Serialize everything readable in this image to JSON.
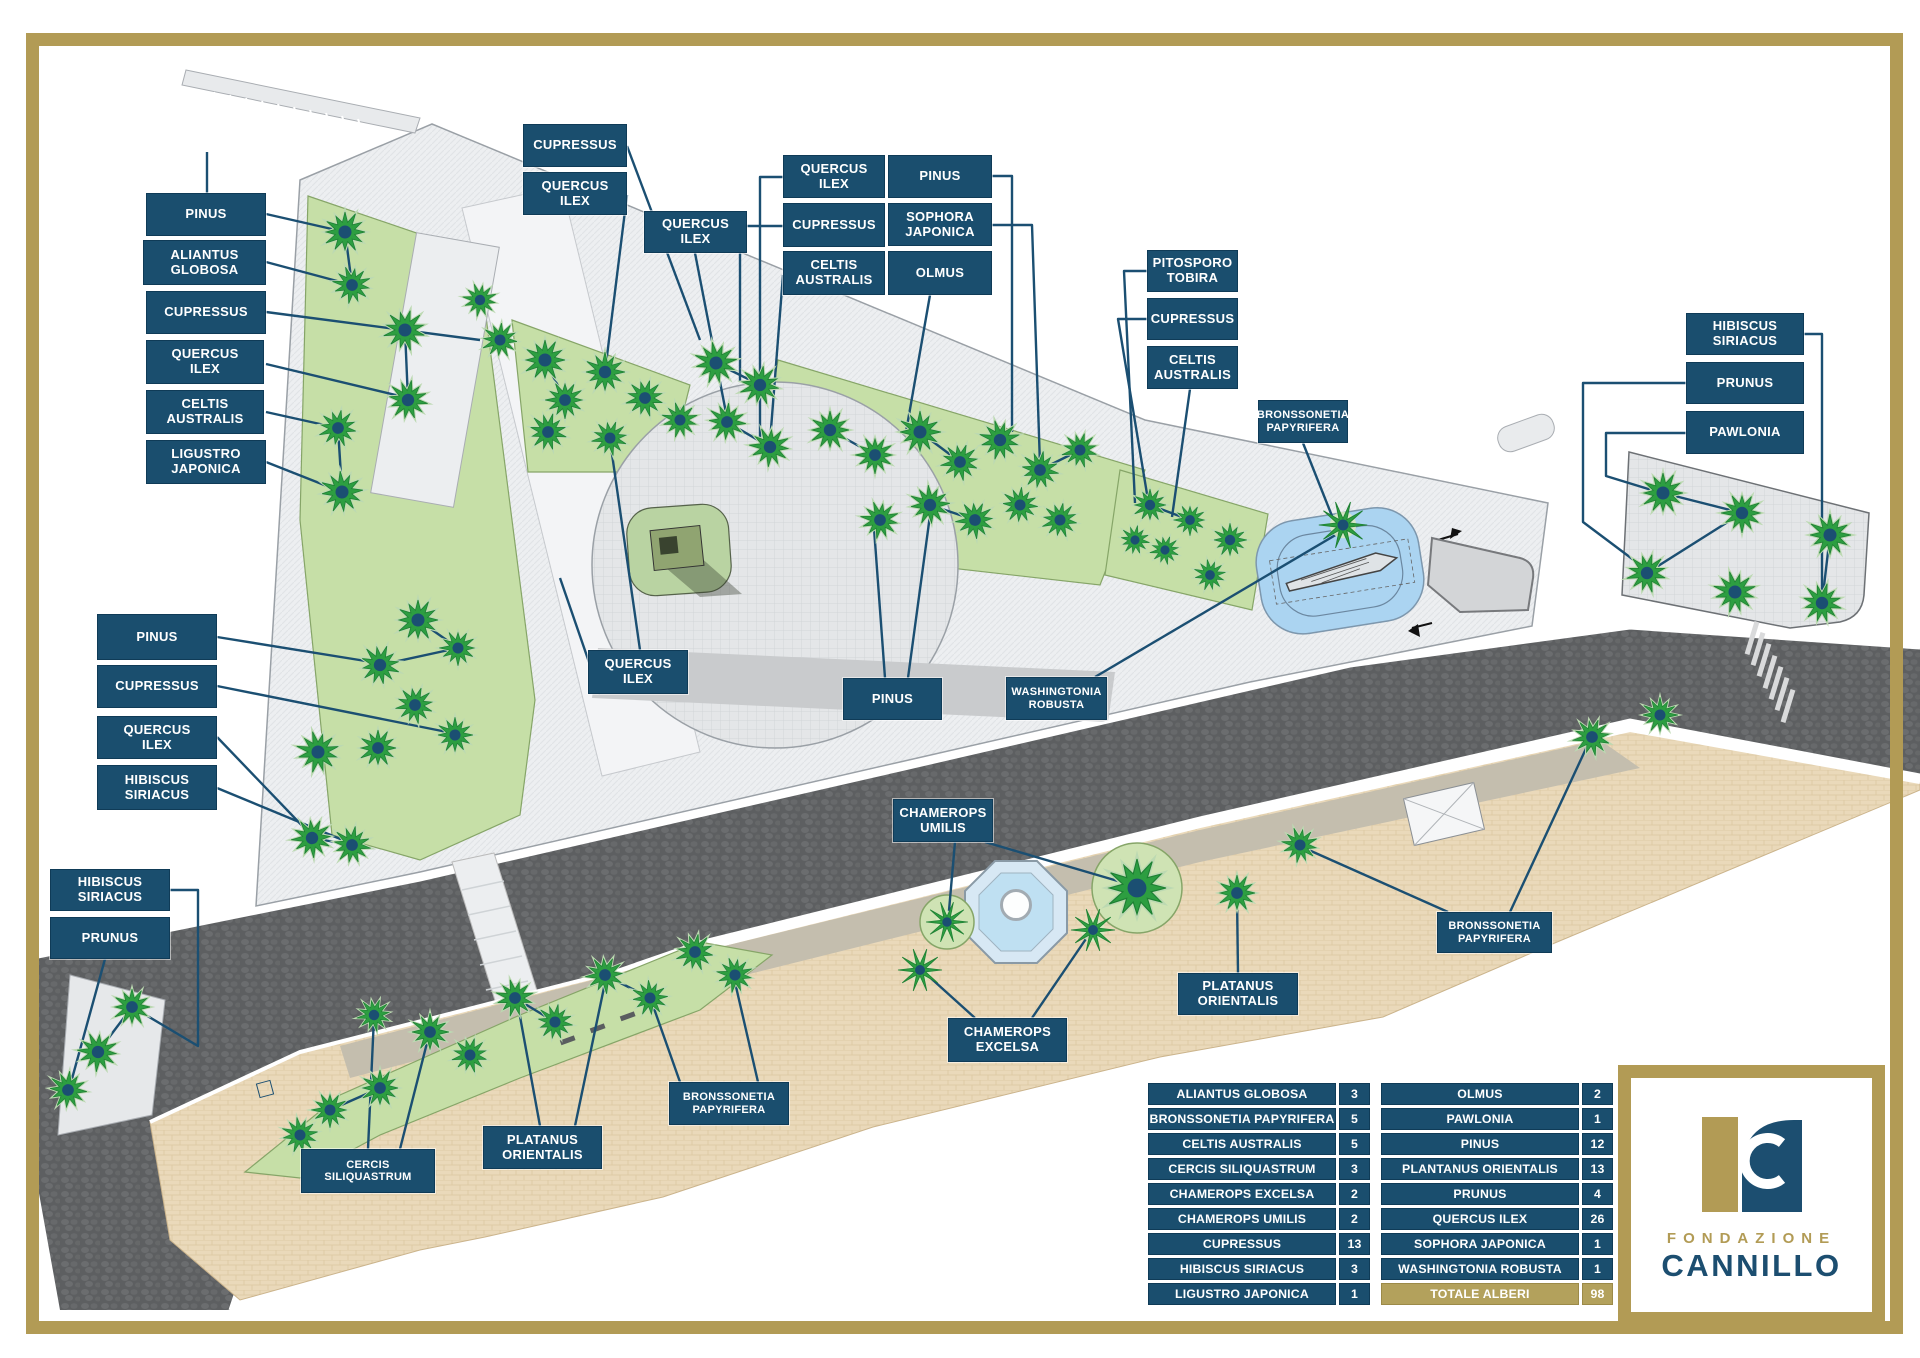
{
  "colors": {
    "frame_gold": "#b29b55",
    "label_navy": "#1a4e6e",
    "leader_navy": "#1b4f72",
    "lawn_green": "#c6dfa7",
    "tree_green": "#2d9e41",
    "road_dark": "#5d5f61",
    "promenade_beige": "#ead9ba",
    "water_blue": "#abd4f1",
    "legend_total_gold": "#b3a15c"
  },
  "map_labels": [
    {
      "text": "PINUS",
      "x": 146,
      "y": 193,
      "w": 120,
      "h": 43
    },
    {
      "text": "ALIANTUS\nGLOBOSA",
      "x": 143,
      "y": 240,
      "w": 123,
      "h": 45
    },
    {
      "text": "CUPRESSUS",
      "x": 146,
      "y": 291,
      "w": 120,
      "h": 43
    },
    {
      "text": "QUERCUS\nILEX",
      "x": 146,
      "y": 340,
      "w": 118,
      "h": 44
    },
    {
      "text": "CELTIS\nAUSTRALIS",
      "x": 146,
      "y": 390,
      "w": 118,
      "h": 44
    },
    {
      "text": "LIGUSTRO\nJAPONICA",
      "x": 146,
      "y": 440,
      "w": 120,
      "h": 44
    },
    {
      "text": "CUPRESSUS",
      "x": 523,
      "y": 124,
      "w": 104,
      "h": 43
    },
    {
      "text": "QUERCUS\nILEX",
      "x": 523,
      "y": 172,
      "w": 104,
      "h": 43
    },
    {
      "text": "QUERCUS\nILEX",
      "x": 644,
      "y": 211,
      "w": 103,
      "h": 42
    },
    {
      "text": "QUERCUS\nILEX",
      "x": 783,
      "y": 155,
      "w": 102,
      "h": 43
    },
    {
      "text": "PINUS",
      "x": 888,
      "y": 155,
      "w": 104,
      "h": 43
    },
    {
      "text": "CUPRESSUS",
      "x": 783,
      "y": 203,
      "w": 102,
      "h": 44
    },
    {
      "text": "SOPHORA\nJAPONICA",
      "x": 888,
      "y": 203,
      "w": 104,
      "h": 43
    },
    {
      "text": "CELTIS\nAUSTRALIS",
      "x": 783,
      "y": 251,
      "w": 102,
      "h": 44
    },
    {
      "text": "OLMUS",
      "x": 888,
      "y": 251,
      "w": 104,
      "h": 44
    },
    {
      "text": "PITOSPORO\nTOBIRA",
      "x": 1147,
      "y": 250,
      "w": 91,
      "h": 42
    },
    {
      "text": "CUPRESSUS",
      "x": 1147,
      "y": 298,
      "w": 91,
      "h": 42
    },
    {
      "text": "CELTIS\nAUSTRALIS",
      "x": 1147,
      "y": 346,
      "w": 91,
      "h": 43
    },
    {
      "text": "BRONSSONETIA\nPAPYRIFERA",
      "x": 1258,
      "y": 400,
      "w": 90,
      "h": 43
    },
    {
      "text": "HIBISCUS\nSIRIACUS",
      "x": 1686,
      "y": 313,
      "w": 118,
      "h": 42
    },
    {
      "text": "PRUNUS",
      "x": 1686,
      "y": 362,
      "w": 118,
      "h": 42
    },
    {
      "text": "PAWLONIA",
      "x": 1686,
      "y": 411,
      "w": 118,
      "h": 43
    },
    {
      "text": "PINUS",
      "x": 97,
      "y": 614,
      "w": 120,
      "h": 46
    },
    {
      "text": "CUPRESSUS",
      "x": 97,
      "y": 665,
      "w": 120,
      "h": 43
    },
    {
      "text": "QUERCUS\nILEX",
      "x": 97,
      "y": 716,
      "w": 120,
      "h": 43
    },
    {
      "text": "HIBISCUS\nSIRIACUS",
      "x": 97,
      "y": 765,
      "w": 120,
      "h": 45
    },
    {
      "text": "QUERCUS\nILEX",
      "x": 588,
      "y": 650,
      "w": 100,
      "h": 44
    },
    {
      "text": "PINUS",
      "x": 843,
      "y": 678,
      "w": 99,
      "h": 42
    },
    {
      "text": "WASHINGTONIA\nROBUSTA",
      "x": 1006,
      "y": 677,
      "w": 101,
      "h": 43
    },
    {
      "text": "HIBISCUS\nSIRIACUS",
      "x": 50,
      "y": 869,
      "w": 120,
      "h": 42
    },
    {
      "text": "PRUNUS",
      "x": 50,
      "y": 917,
      "w": 120,
      "h": 42
    },
    {
      "text": "CHAMEROPS\nUMILIS",
      "x": 893,
      "y": 799,
      "w": 100,
      "h": 43
    },
    {
      "text": "CHAMEROPS\nEXCELSA",
      "x": 948,
      "y": 1018,
      "w": 119,
      "h": 44
    },
    {
      "text": "PLATANUS\nORIENTALIS",
      "x": 1178,
      "y": 973,
      "w": 120,
      "h": 42
    },
    {
      "text": "BRONSSONETIA\nPAPYRIFERA",
      "x": 1437,
      "y": 912,
      "w": 115,
      "h": 41
    },
    {
      "text": "BRONSSONETIA\nPAPYRIFERA",
      "x": 669,
      "y": 1082,
      "w": 120,
      "h": 43
    },
    {
      "text": "PLATANUS\nORIENTALIS",
      "x": 483,
      "y": 1126,
      "w": 119,
      "h": 43
    },
    {
      "text": "CERCIS\nSILIQUASTRUM",
      "x": 301,
      "y": 1149,
      "w": 134,
      "h": 44
    }
  ],
  "legend": {
    "left_rows": [
      {
        "name": "ALIANTUS GLOBOSA",
        "count": 3
      },
      {
        "name": "BRONSSONETIA PAPYRIFERA",
        "count": 5
      },
      {
        "name": "CELTIS AUSTRALIS",
        "count": 5
      },
      {
        "name": "CERCIS SILIQUASTRUM",
        "count": 3
      },
      {
        "name": "CHAMEROPS EXCELSA",
        "count": 2
      },
      {
        "name": "CHAMEROPS UMILIS",
        "count": 2
      },
      {
        "name": "CUPRESSUS",
        "count": 13
      },
      {
        "name": "HIBISCUS SIRIACUS",
        "count": 3
      },
      {
        "name": "LIGUSTRO JAPONICA",
        "count": 1
      }
    ],
    "right_rows": [
      {
        "name": "OLMUS",
        "count": 2
      },
      {
        "name": "PAWLONIA",
        "count": 1
      },
      {
        "name": "PINUS",
        "count": 12
      },
      {
        "name": "PLANTANUS ORIENTALIS",
        "count": 13
      },
      {
        "name": "PRUNUS",
        "count": 4
      },
      {
        "name": "QUERCUS ILEX",
        "count": 26
      },
      {
        "name": "SOPHORA JAPONICA",
        "count": 1
      },
      {
        "name": "WASHINGTONIA ROBUSTA",
        "count": 1
      }
    ],
    "total": {
      "name": "TOTALE ALBERI",
      "count": 98
    }
  },
  "logo": {
    "org_line1": "FONDAZIONE",
    "org_line2": "CANNILLO",
    "monogram": "C"
  }
}
